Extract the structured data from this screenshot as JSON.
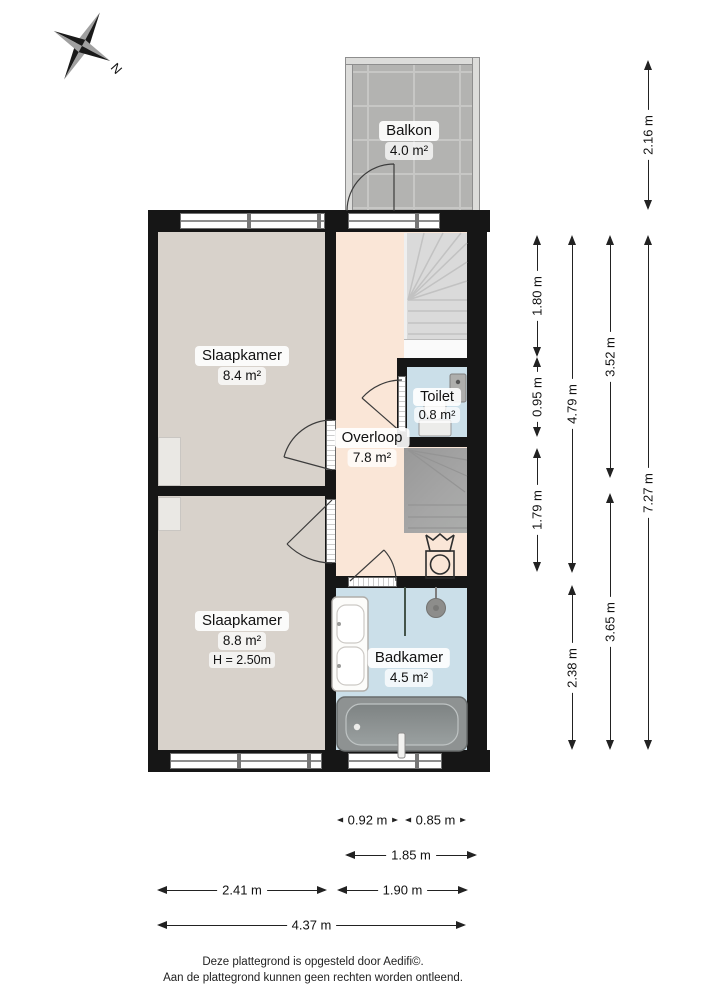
{
  "compass": {
    "north_label": "N"
  },
  "rooms": {
    "balkon": {
      "name": "Balkon",
      "area": "4.0 m²"
    },
    "slaapkamer_boven": {
      "name": "Slaapkamer",
      "area": "8.4 m²"
    },
    "toilet": {
      "name": "Toilet",
      "area": "0.8 m²"
    },
    "overloop": {
      "name": "Overloop",
      "area": "7.8 m²"
    },
    "slaapkamer_onder": {
      "name": "Slaapkamer",
      "area": "8.8 m²",
      "ceiling_height": "H = 2.50m"
    },
    "badkamer": {
      "name": "Badkamer",
      "area": "4.5 m²"
    }
  },
  "dimensions": {
    "right": [
      {
        "label": "2.16 m"
      },
      {
        "label": "1.80 m"
      },
      {
        "label": "0.95 m"
      },
      {
        "label": "1.79 m"
      },
      {
        "label": "4.79 m"
      },
      {
        "label": "2.38 m"
      },
      {
        "label": "3.52 m"
      },
      {
        "label": "3.65 m"
      },
      {
        "label": "7.27 m"
      }
    ],
    "bottom": [
      {
        "label": "0.92 m"
      },
      {
        "label": "0.85 m"
      },
      {
        "label": "1.85 m"
      },
      {
        "label": "2.41 m"
      },
      {
        "label": "1.90 m"
      },
      {
        "label": "4.37 m"
      }
    ]
  },
  "footer": {
    "line1": "Deze plattegrond is opgesteld door Aedifi©.",
    "line2": "Aan de plattegrond kunnen geen rechten worden ontleend."
  },
  "colors": {
    "wall": "#161616",
    "bedroom_floor": "#d8d2cb",
    "hall_floor": "#fae6d7",
    "wet_floor": "#cbdfe9",
    "balkon_tile": "#b3b3b1",
    "stair_light": "#dadada",
    "stair_dark": "#a0a0a0",
    "bathtub": "#8e9292",
    "dimension_line": "#222222"
  }
}
